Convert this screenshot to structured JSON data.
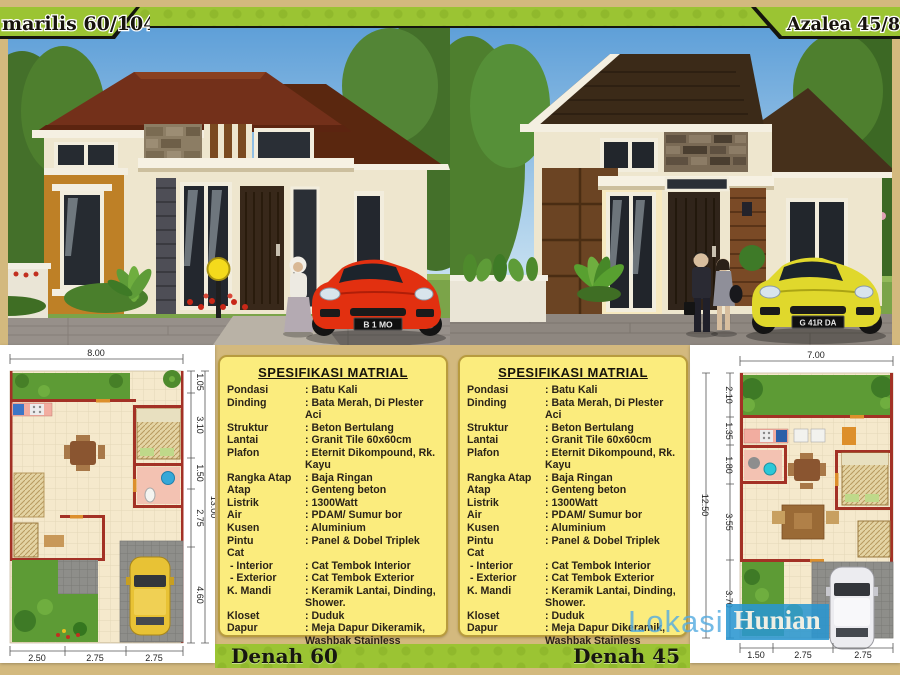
{
  "header": {
    "title_left": "marilis 60/104",
    "title_right": "Azalea 45/87.5"
  },
  "scene_left": {
    "plate": "B 1 MO"
  },
  "scene_right": {
    "plate": "G 41R DA"
  },
  "spec": {
    "title": "SPESIFIKASI MATRIAL",
    "rows": [
      [
        "Pondasi",
        ": Batu Kali"
      ],
      [
        "Dinding",
        ": Bata Merah, Di Plester Aci"
      ],
      [
        "Struktur",
        ": Beton Bertulang"
      ],
      [
        "Lantai",
        ": Granit Tile 60x60cm"
      ],
      [
        "Plafon",
        ": Eternit Dikompound, Rk. Kayu"
      ],
      [
        "Rangka Atap",
        ": Baja Ringan"
      ],
      [
        "Atap",
        ": Genteng beton"
      ],
      [
        "Listrik",
        ": 1300Watt"
      ],
      [
        "Air",
        ": PDAM/ Sumur bor"
      ],
      [
        "Kusen",
        ": Aluminium"
      ],
      [
        "Pintu",
        ": Panel & Dobel Triplek"
      ],
      [
        "Cat",
        ""
      ],
      [
        " - Interior",
        ": Cat Tembok Interior"
      ],
      [
        " - Exterior",
        ": Cat Tembok Exterior"
      ],
      [
        "K. Mandi",
        ": Keramik Lantai, Dinding, Shower."
      ],
      [
        "Kloset",
        ": Duduk"
      ],
      [
        "Dapur",
        ": Meja Dapur Dikeramik,\nWashbak Stainless"
      ],
      [
        "Carport",
        ": Floor"
      ]
    ]
  },
  "plan_left": {
    "label": "Denah 60",
    "top_dim": "8.00",
    "total_dim": "13.00",
    "side_dims": [
      "1.05",
      "3.10",
      "1.50",
      "2.75",
      "4.60"
    ],
    "bottom_dims": [
      "2.50",
      "2.75",
      "2.75"
    ]
  },
  "plan_right": {
    "label": "Denah 45",
    "top_dim": "7.00",
    "total_dim": "12.50",
    "side_dims": [
      "2.10",
      "1.35",
      "1.80",
      "3.55",
      "3.70"
    ],
    "bottom_dims": [
      "1.50",
      "2.75",
      "2.75"
    ]
  },
  "watermark": {
    "part1": "Lokasi",
    "part2": "Hunian"
  },
  "colors": {
    "band_green": "#9BC433",
    "backdrop_tan": "#D3B97E",
    "spec_yellow": "#FBEC7D",
    "roof_brown_left": "#73301A",
    "roof_brown_right": "#3B2A18",
    "accent_orange": "#BE8026",
    "accent_panel_brown": "#6B4423",
    "car_red": "#E23010",
    "car_yellow": "#E0D82C",
    "watermark_blue": "#2A96D0",
    "plan_wall_red": "#A33125",
    "plan_garden_green": "#5D9B35"
  }
}
